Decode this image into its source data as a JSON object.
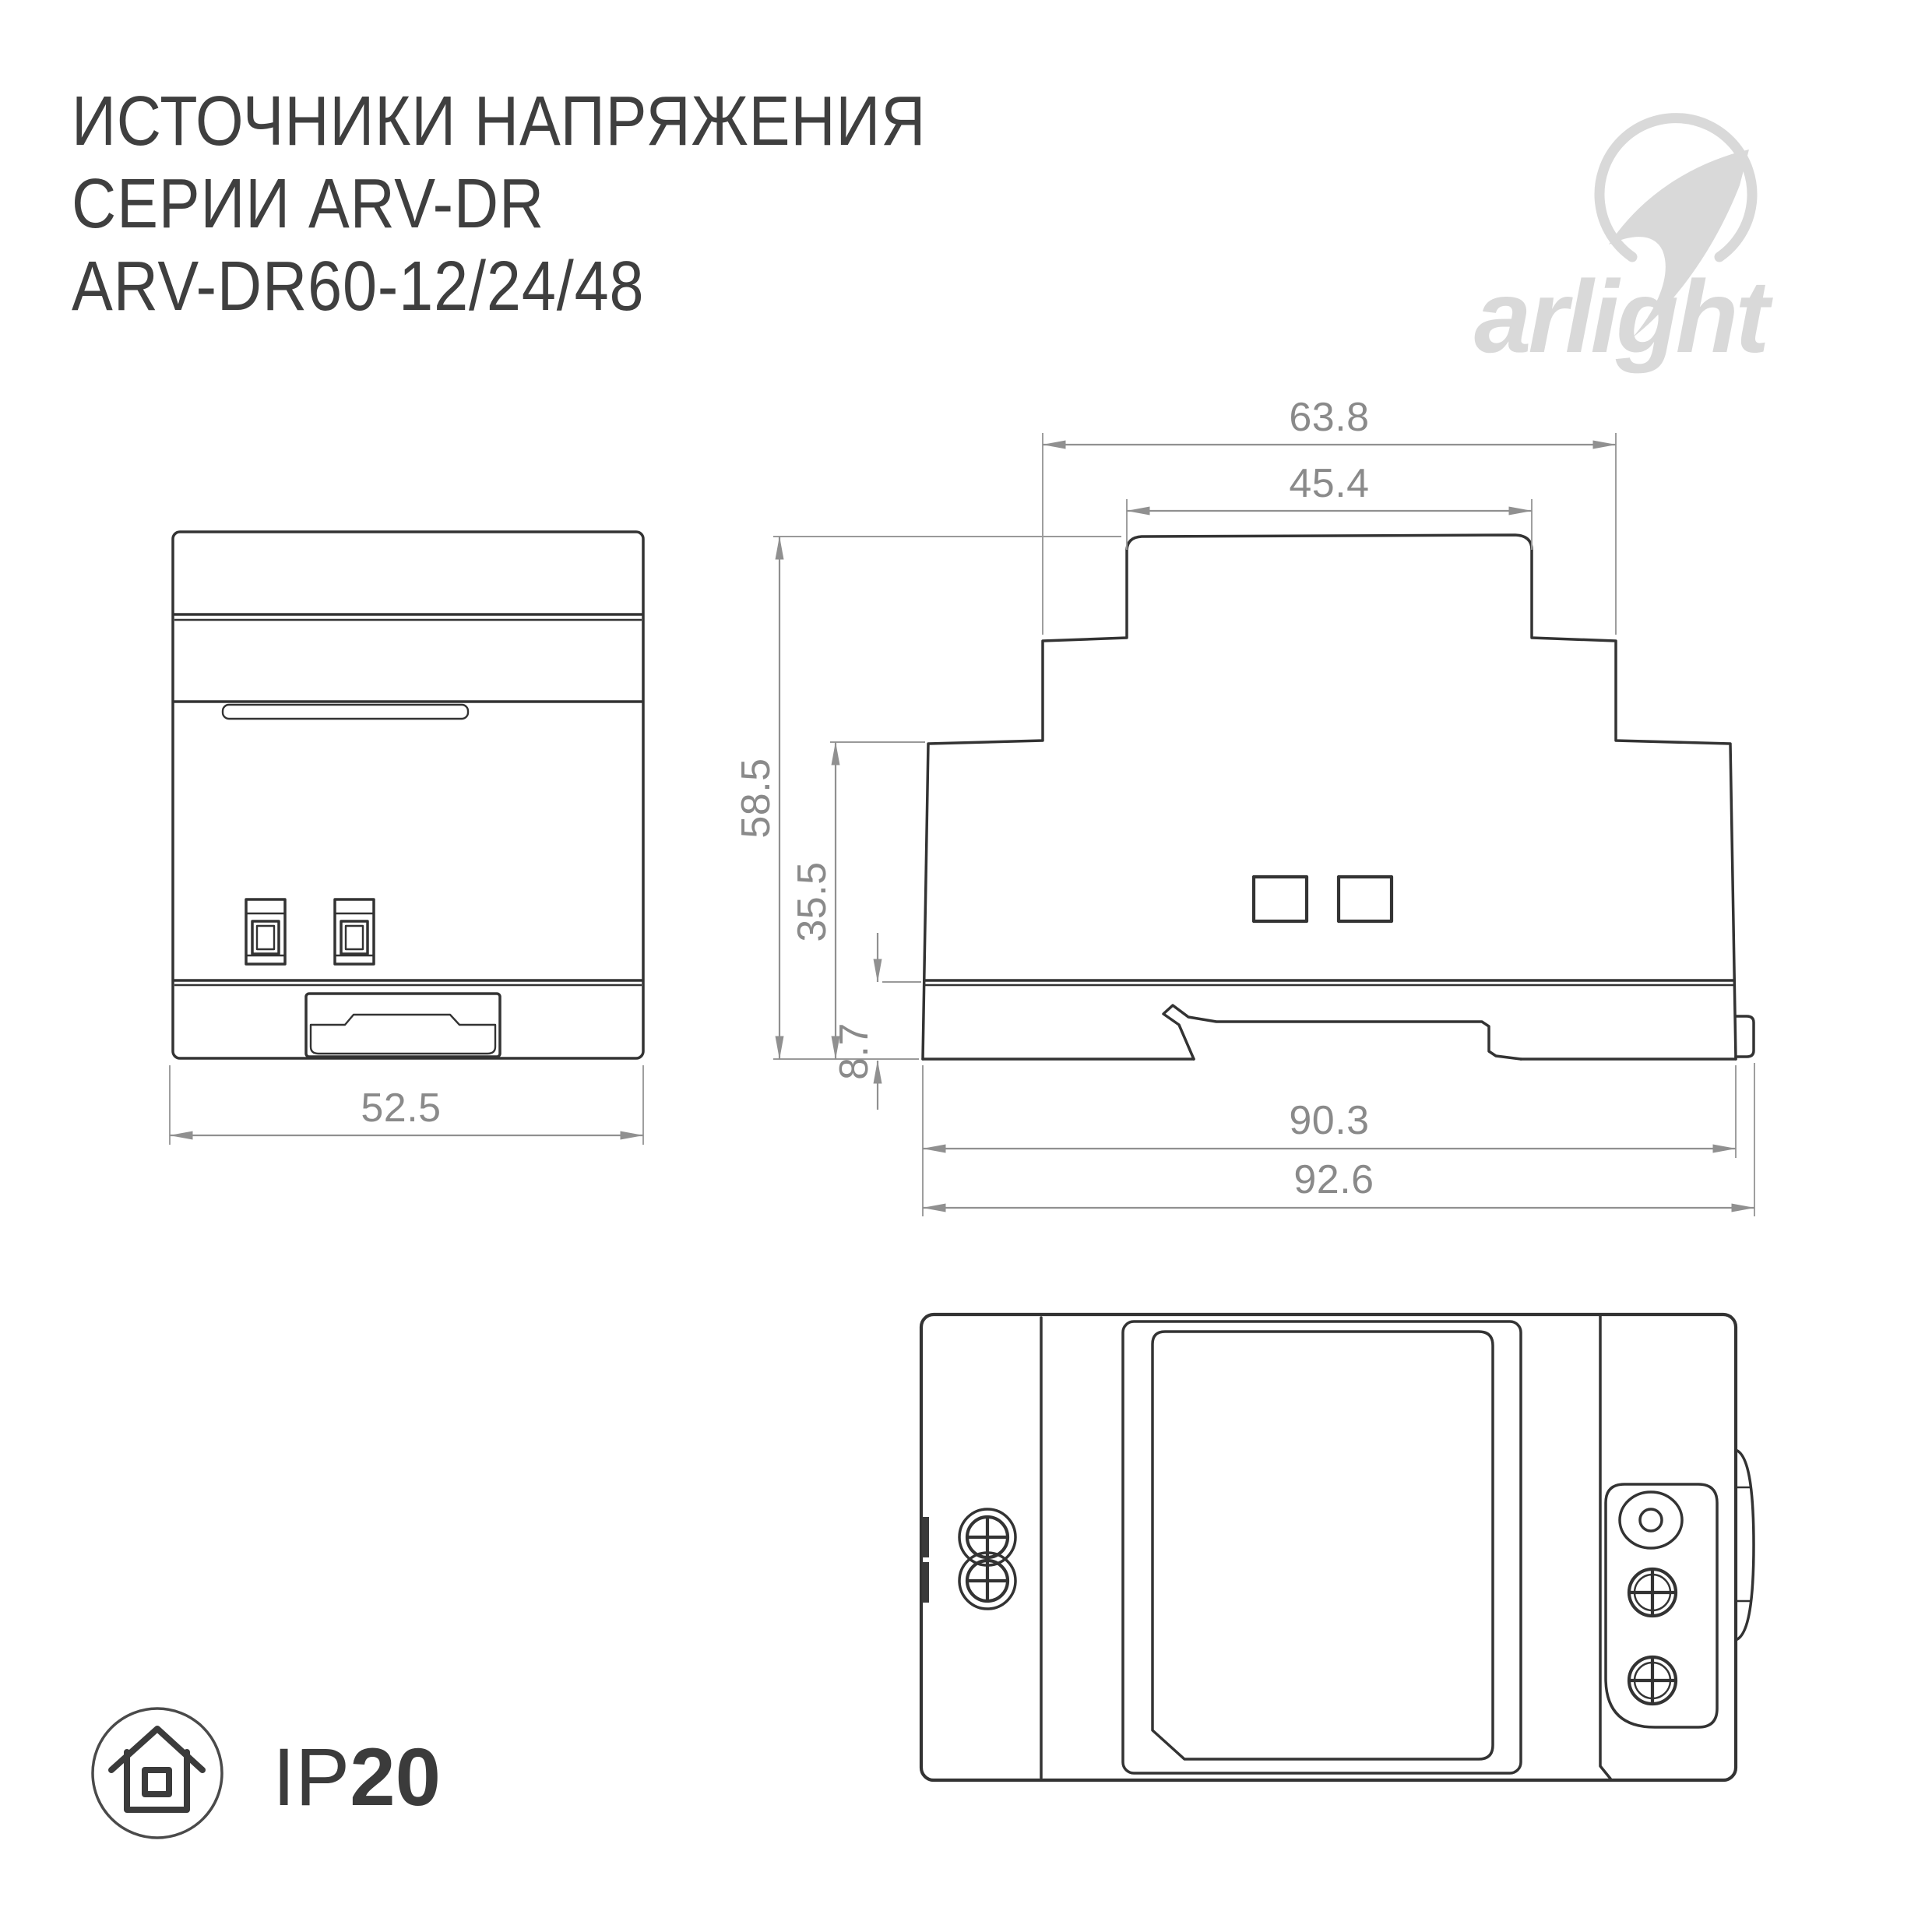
{
  "title": {
    "line1": "ИСТОЧНИКИ НАПРЯЖЕНИЯ",
    "line2": "СЕРИИ ARV-DR",
    "line3": "ARV-DR60-12/24/48"
  },
  "brand": {
    "wordmark": "arlight"
  },
  "badge": {
    "prefix": "IP",
    "value": "20"
  },
  "dims": {
    "front_width": "52.5",
    "top_width": "63.8",
    "top_inner_width": "45.4",
    "total_height": "58.5",
    "body_height": "35.5",
    "rail_height": "8.7",
    "body_width": "90.3",
    "full_width": "92.6"
  },
  "icons": {
    "logo_mark": "swoosh-circle-icon",
    "ip_badge": "house-icon",
    "screw": "phillips-screw-icon",
    "hole": "round-hole-icon"
  },
  "colors": {
    "line": "#333333",
    "dimension": "#909090",
    "logo": "#d9d9d9",
    "title": "#3f3f3f"
  }
}
